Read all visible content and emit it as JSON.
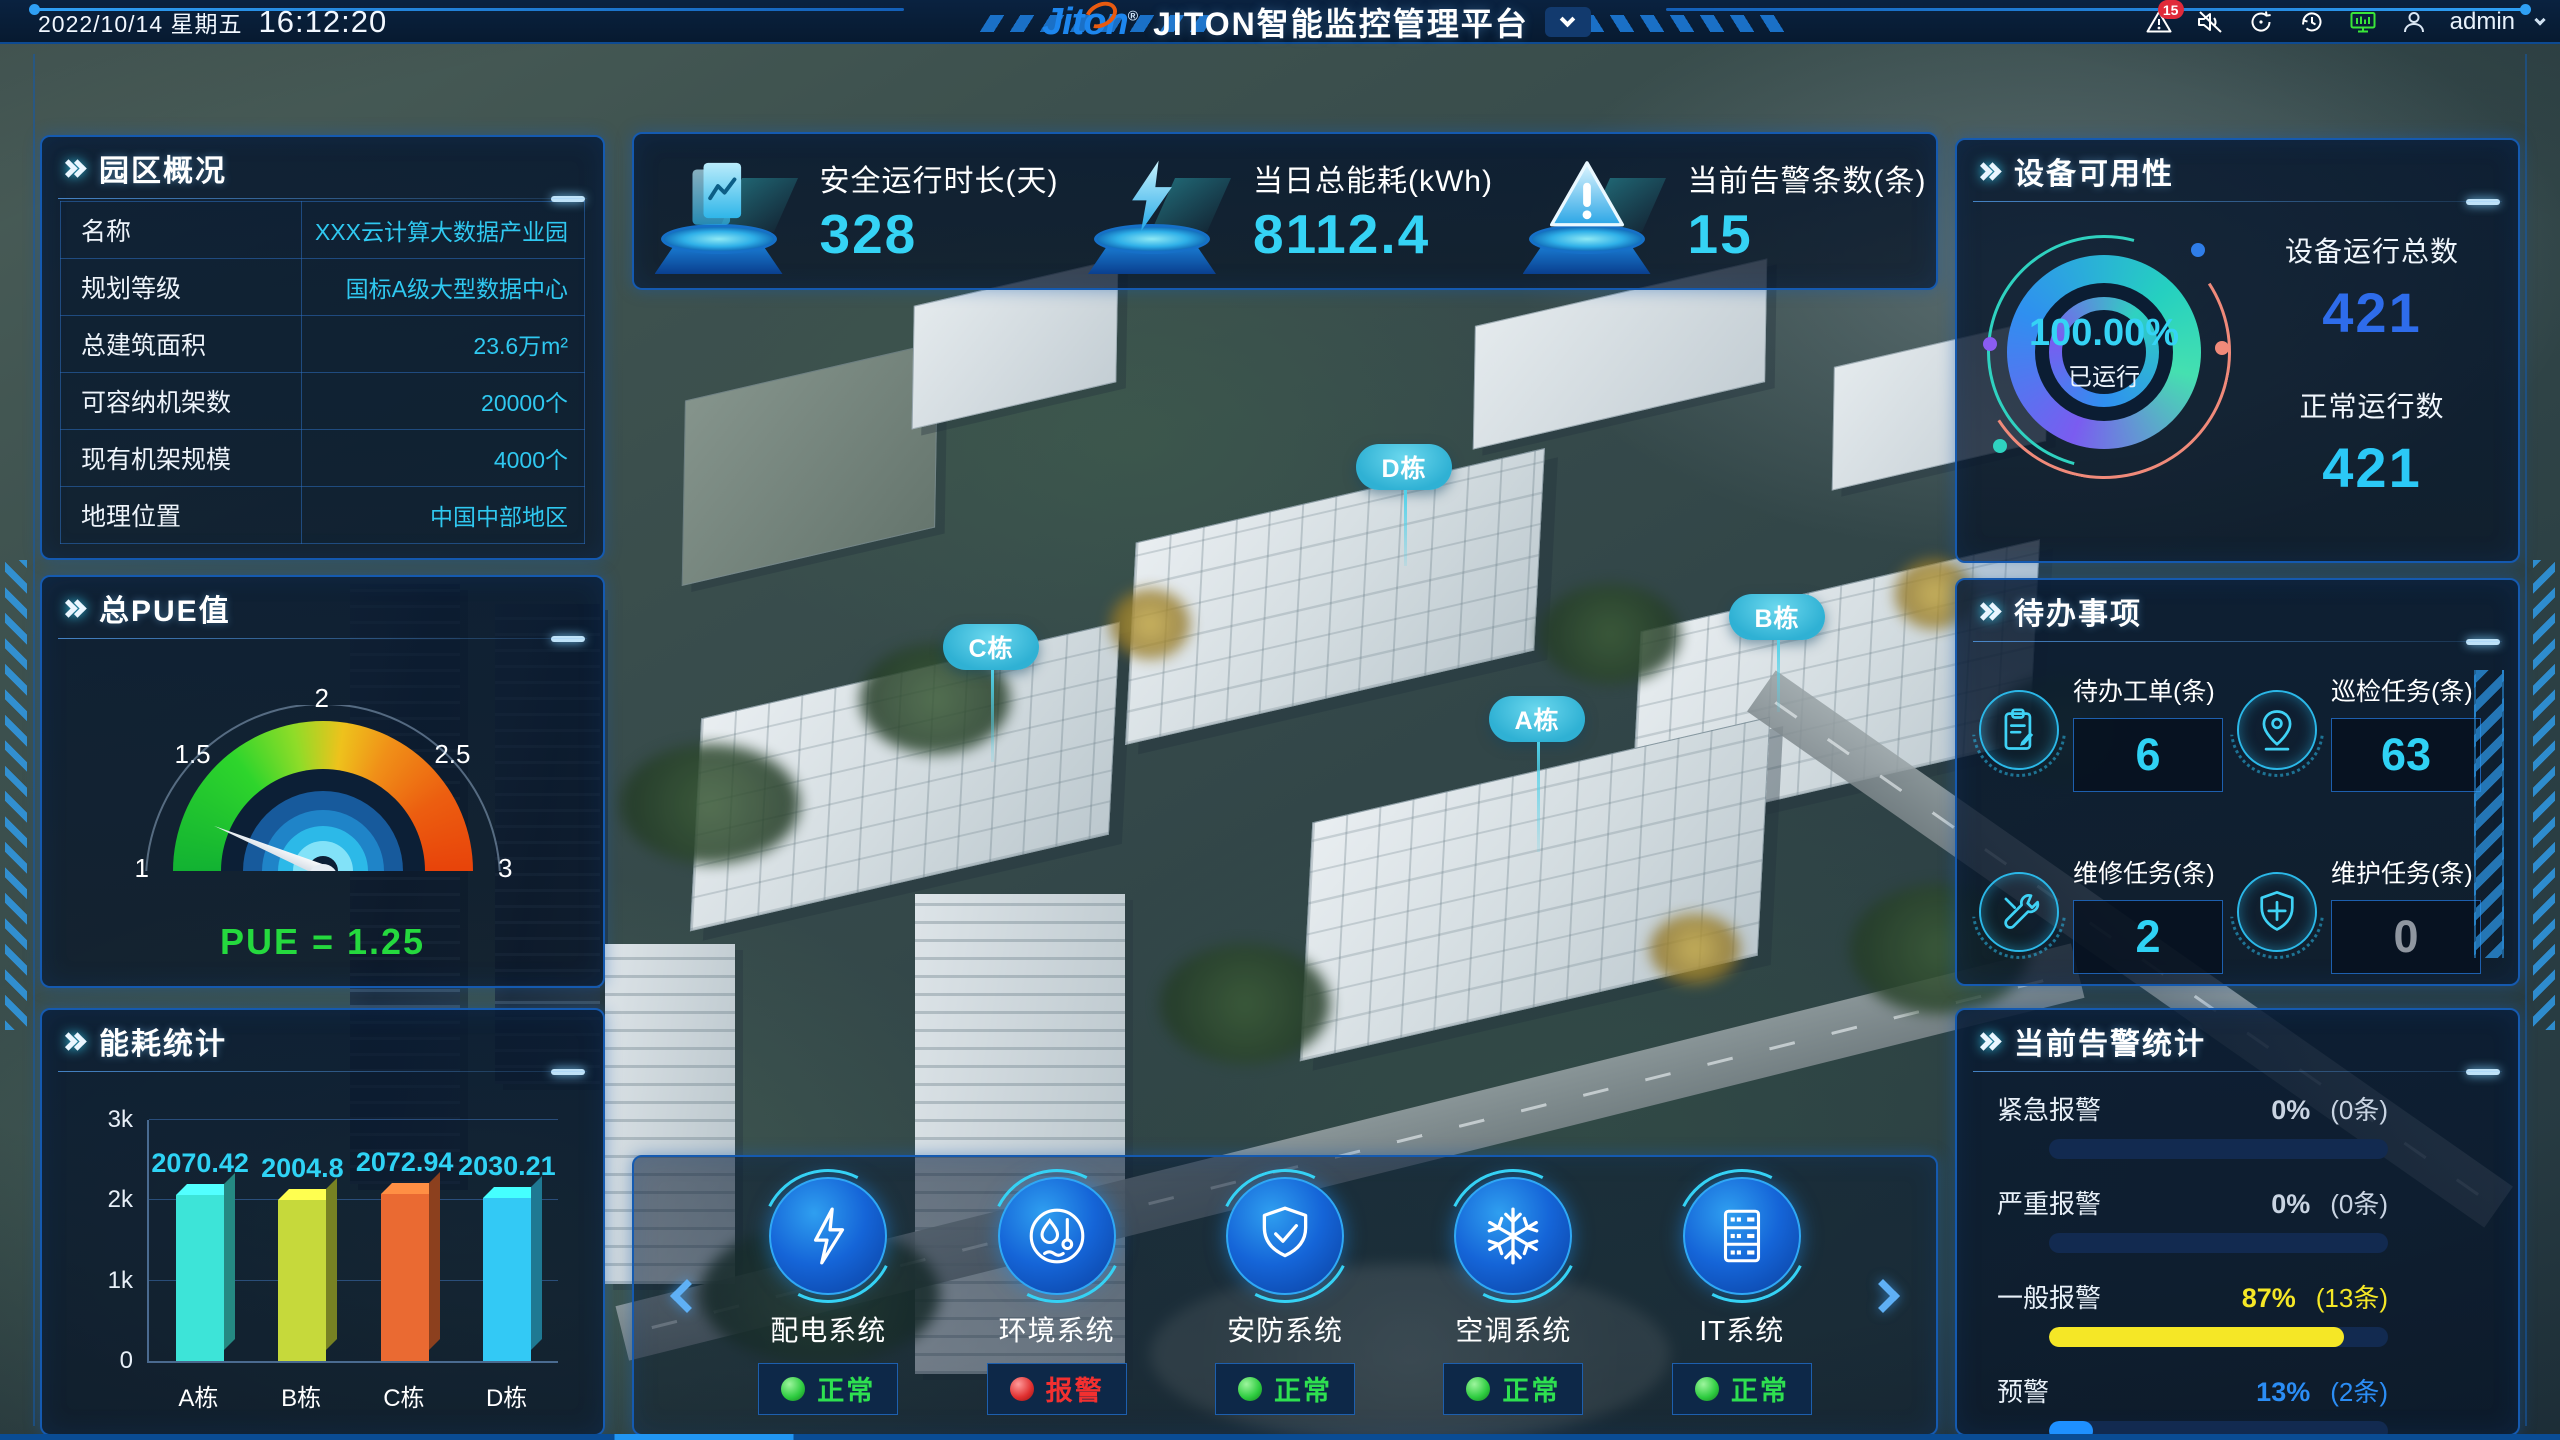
{
  "header": {
    "date": "2022/10/14 星期五",
    "time": "16:12:20",
    "logo": "Jiton",
    "logo_reg": "®",
    "title": "JITON智能监控管理平台",
    "alarm_badge": "15",
    "username": "admin"
  },
  "park_overview": {
    "title": "园区概况",
    "rows": [
      {
        "label": "名称",
        "value": "XXX云计算大数据产业园"
      },
      {
        "label": "规划等级",
        "value": "国标A级大型数据中心"
      },
      {
        "label": "总建筑面积",
        "value": "23.6万m²"
      },
      {
        "label": "可容纳机架数",
        "value": "20000个"
      },
      {
        "label": "现有机架规模",
        "value": "4000个"
      },
      {
        "label": "地理位置",
        "value": "中国中部地区"
      }
    ]
  },
  "kpi_cards": [
    {
      "icon": "report-icon",
      "label": "安全运行时长(天)",
      "value": "328"
    },
    {
      "icon": "lightning-icon",
      "label": "当日总能耗(kWh)",
      "value": "8112.4"
    },
    {
      "icon": "alert-icon",
      "label": "当前告警条数(条)",
      "value": "15"
    }
  ],
  "device_availability": {
    "title": "设备可用性",
    "stats": [
      {
        "label": "设备运行总数",
        "value": "421",
        "color": "#2e6ceb"
      },
      {
        "label": "正常运行数",
        "value": "421",
        "color": "#2bc9f6"
      }
    ]
  },
  "todo": {
    "title": "待办事项",
    "items": [
      {
        "icon": "clipboard-icon",
        "label": "待办工单(条)",
        "value": "6",
        "value_color": "#2fd2f5"
      },
      {
        "icon": "location-pin-icon",
        "label": "巡检任务(条)",
        "value": "63",
        "value_color": "#2fd2f5"
      },
      {
        "icon": "tools-icon",
        "label": "维修任务(条)",
        "value": "2",
        "value_color": "#2fd2f5"
      },
      {
        "icon": "shield-icon",
        "label": "维护任务(条)",
        "value": "0",
        "value_color": "#8f96a0"
      }
    ]
  },
  "systems": {
    "items": [
      {
        "icon": "power-icon",
        "name": "配电系统",
        "status": "正常",
        "status_type": "ok"
      },
      {
        "icon": "environment-icon",
        "name": "环境系统",
        "status": "报警",
        "status_type": "alarm"
      },
      {
        "icon": "security-shield-icon",
        "name": "安防系统",
        "status": "正常",
        "status_type": "ok"
      },
      {
        "icon": "snowflake-icon",
        "name": "空调系统",
        "status": "正常",
        "status_type": "ok"
      },
      {
        "icon": "server-icon",
        "name": "IT系统",
        "status": "正常",
        "status_type": "ok"
      }
    ]
  },
  "map": {
    "buildings": [
      {
        "label": "D栋"
      },
      {
        "label": "C栋"
      },
      {
        "label": "B栋"
      },
      {
        "label": "A栋"
      }
    ]
  },
  "chart_data": [
    {
      "type": "bar",
      "title": "能耗统计",
      "categories": [
        "A栋",
        "B栋",
        "C栋",
        "D栋"
      ],
      "values": [
        2070.42,
        2004.8,
        2072.94,
        2030.21
      ],
      "value_labels": [
        "2070.42",
        "2004.8",
        "2072.94",
        "2030.21"
      ],
      "colors": [
        "#3de4d8",
        "#c6d93b",
        "#ea6a32",
        "#33c9f5"
      ],
      "ylim": [
        0,
        3000
      ],
      "ytick_labels": [
        "0",
        "1k",
        "2k",
        "3k"
      ],
      "grid": true,
      "legend": false
    },
    {
      "type": "gauge",
      "title": "总PUE值",
      "min": 1,
      "max": 3,
      "value": 1.25,
      "tick_labels": [
        "1",
        "1.5",
        "2",
        "2.5",
        "3"
      ],
      "label": "PUE = 1.25",
      "label_color": "#25d93e"
    },
    {
      "type": "donut",
      "title": "设备可用性",
      "value_pct": 100,
      "center_label": "100.00%",
      "sub_label": "已运行"
    },
    {
      "type": "bar",
      "title": "当前告警统计",
      "orientation": "horizontal",
      "categories": [
        "紧急报警",
        "严重报警",
        "一般报警",
        "预警"
      ],
      "values": [
        0,
        0,
        87,
        13
      ],
      "percent_labels": [
        "0%",
        "0%",
        "87%",
        "13%"
      ],
      "count_labels": [
        "(0条)",
        "(0条)",
        "(13条)",
        "(2条)"
      ],
      "colors": [
        "#c9d4e2",
        "#c9d4e2",
        "#f5e726",
        "#2b8df5"
      ],
      "bar_colors": [
        "#f5e726",
        "#f5e726",
        "#f5e726",
        "#1e90ff"
      ],
      "xlim": [
        0,
        100
      ]
    }
  ]
}
